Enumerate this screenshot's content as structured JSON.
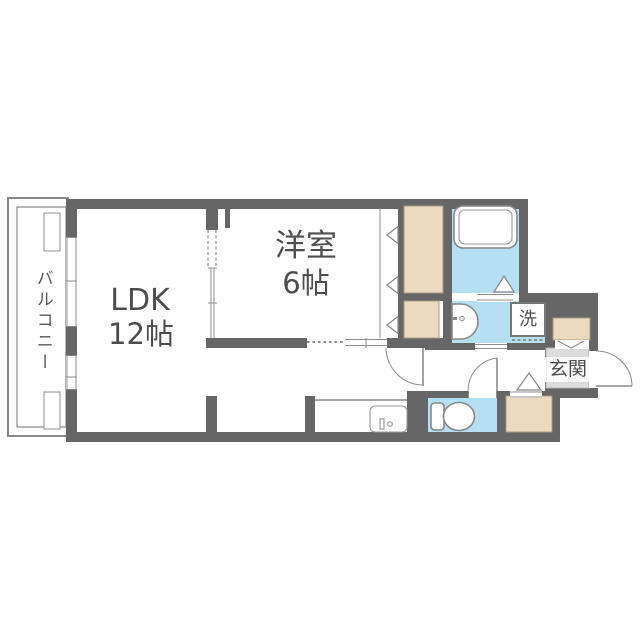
{
  "plan": {
    "type": "apartment-floorplan",
    "rooms": {
      "balcony": {
        "label": "バルコニー"
      },
      "ldk": {
        "label": "LDK",
        "size": "12帖"
      },
      "bedroom": {
        "label": "洋室",
        "size": "6帖"
      },
      "entrance": {
        "label": "玄関"
      },
      "laundry": {
        "label": "洗"
      }
    },
    "fixtures": [
      "bathtub",
      "washbasin",
      "washing-machine",
      "toilet",
      "kitchen-sink",
      "closet",
      "shoe-cabinet",
      "storage",
      "air-conditioner-units"
    ],
    "colors": {
      "wall": "#666666",
      "wet_floor": "#b5dff2",
      "closet_fill": "#ebd9c0",
      "entrance_floor": "#dcdcdc",
      "line": "#8c8c8c",
      "text": "#4d4d4d",
      "background": "#ffffff"
    }
  }
}
